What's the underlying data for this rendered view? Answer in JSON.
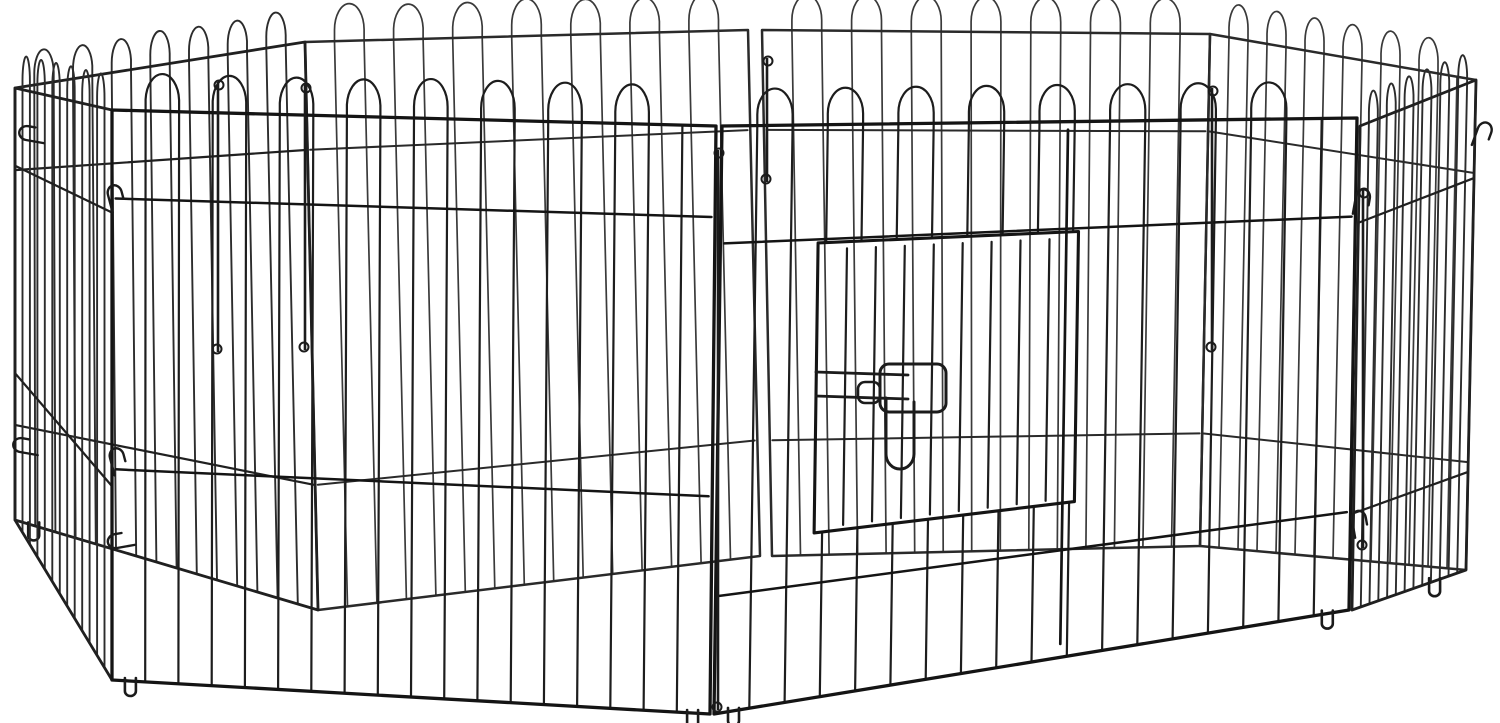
{
  "product": {
    "name": "8-Panel Octagonal Metal Pet Playpen with Door",
    "description": "Black metal wire dog exercise pen with looped-top panels, a hinged wire door with sliding latch, corner connector hooks and ground feet, photographed on a plain white background",
    "finish_color": "#1d1d1d",
    "background_color": "#ffffff"
  },
  "canvas": {
    "width": 1500,
    "height": 723
  },
  "scene": {
    "background": "#ffffff",
    "style": {
      "back": {
        "wire_color": "#3a3a3a",
        "wire_width": 1.7,
        "frame_color": "#2a2a2a",
        "frame_width": 2.5,
        "rail_width": 2.0
      },
      "mid": {
        "wire_color": "#2c2c2c",
        "wire_width": 1.9,
        "frame_color": "#202020",
        "frame_width": 2.8,
        "rail_width": 2.2
      },
      "front": {
        "wire_color": "#1d1d1d",
        "wire_width": 2.2,
        "frame_color": "#141414",
        "frame_width": 3.3,
        "rail_width": 2.5
      }
    },
    "loop_rise_ratio": 0.02,
    "loop_height_ratio": 0.048,
    "hardware_color": "#1b1b1b",
    "panels": [
      {
        "id": "back-center",
        "depth": "back",
        "quad": {
          "tl": [
            762,
            30
          ],
          "tr": [
            1210,
            34
          ],
          "br": [
            1200,
            546
          ],
          "bl": [
            772,
            556
          ]
        },
        "wires": 14,
        "rails": [
          0.19,
          0.78
        ]
      },
      {
        "id": "back-left",
        "depth": "back",
        "quad": {
          "tl": [
            305,
            42
          ],
          "tr": [
            748,
            30
          ],
          "br": [
            760,
            556
          ],
          "bl": [
            318,
            610
          ]
        },
        "wires": 14,
        "rails": [
          0.19,
          0.78
        ]
      },
      {
        "id": "back-right",
        "depth": "back",
        "quad": {
          "tl": [
            1210,
            34
          ],
          "tr": [
            1476,
            80
          ],
          "br": [
            1466,
            570
          ],
          "bl": [
            1200,
            546
          ]
        },
        "wires": 13,
        "rails": [
          0.19,
          0.78
        ]
      },
      {
        "id": "left-rear",
        "depth": "mid",
        "quad": {
          "tl": [
            15,
            88
          ],
          "tr": [
            305,
            42
          ],
          "br": [
            318,
            610
          ],
          "bl": [
            15,
            520
          ]
        },
        "wires": 14,
        "rails": [
          0.19,
          0.78
        ],
        "feet": [
          0.06
        ]
      },
      {
        "id": "right-side",
        "depth": "mid",
        "quad": {
          "tl": [
            1360,
            126
          ],
          "tr": [
            1476,
            80
          ],
          "br": [
            1466,
            570
          ],
          "bl": [
            1352,
            610
          ]
        },
        "wires": 12,
        "rails": [
          0.2,
          0.8
        ],
        "feet": [
          0.72
        ]
      },
      {
        "id": "left-side",
        "depth": "mid",
        "quad": {
          "tl": [
            15,
            88
          ],
          "tr": [
            112,
            110
          ],
          "br": [
            112,
            680
          ],
          "bl": [
            15,
            520
          ]
        },
        "wires": 12,
        "rails": [
          0.18,
          0.66
        ]
      },
      {
        "id": "front-left",
        "depth": "front",
        "quad": {
          "tl": [
            112,
            110
          ],
          "tr": [
            716,
            126
          ],
          "br": [
            710,
            714
          ],
          "bl": [
            112,
            680
          ]
        },
        "wires": 17,
        "rails": [
          0.155,
          0.63
        ],
        "feet": [
          0.03,
          0.97
        ]
      },
      {
        "id": "front-door",
        "depth": "front",
        "quad": {
          "tl": [
            722,
            126
          ],
          "tr": [
            1357,
            118
          ],
          "br": [
            1349,
            610
          ],
          "bl": [
            714,
            714
          ]
        },
        "wires": 17,
        "rails": [
          0.2,
          0.8
        ],
        "feet": [
          0.03,
          0.965
        ],
        "door": {
          "left": 0.154,
          "right": 0.564,
          "top": 0.206,
          "bottom": 0.712,
          "wires": 8,
          "hinge": 0.545
        },
        "latch": {
          "box": [
            880,
            364,
            946,
            412
          ],
          "prongs": [
            [
              816,
              372,
              908,
              375
            ],
            [
              816,
              396,
              908,
              399
            ]
          ],
          "handle": [
            886,
            398,
            914,
            468
          ],
          "clip": [
            858,
            382,
            880,
            403
          ]
        }
      }
    ],
    "pins": [
      {
        "x": 718,
        "y1": 150,
        "y2": 710
      },
      {
        "x": 1363,
        "y1": 190,
        "y2": 548
      },
      {
        "x": 305,
        "y1": 85,
        "y2": 350
      },
      {
        "x": 218,
        "y1": 82,
        "y2": 352
      },
      {
        "x": 1212,
        "y1": 88,
        "y2": 350
      },
      {
        "x": 767,
        "y1": 58,
        "y2": 182
      }
    ],
    "hooks": [
      {
        "x": 26,
        "y": 140,
        "angle": -80
      },
      {
        "x": 20,
        "y": 452,
        "angle": -80
      },
      {
        "x": 108,
        "y": 195,
        "angle": -15
      },
      {
        "x": 110,
        "y": 458,
        "angle": -15
      },
      {
        "x": 117,
        "y": 548,
        "angle": -100
      },
      {
        "x": 1478,
        "y": 128,
        "angle": 20
      },
      {
        "x": 1356,
        "y": 196,
        "angle": 10
      },
      {
        "x": 1352,
        "y": 520,
        "angle": -10
      }
    ]
  }
}
